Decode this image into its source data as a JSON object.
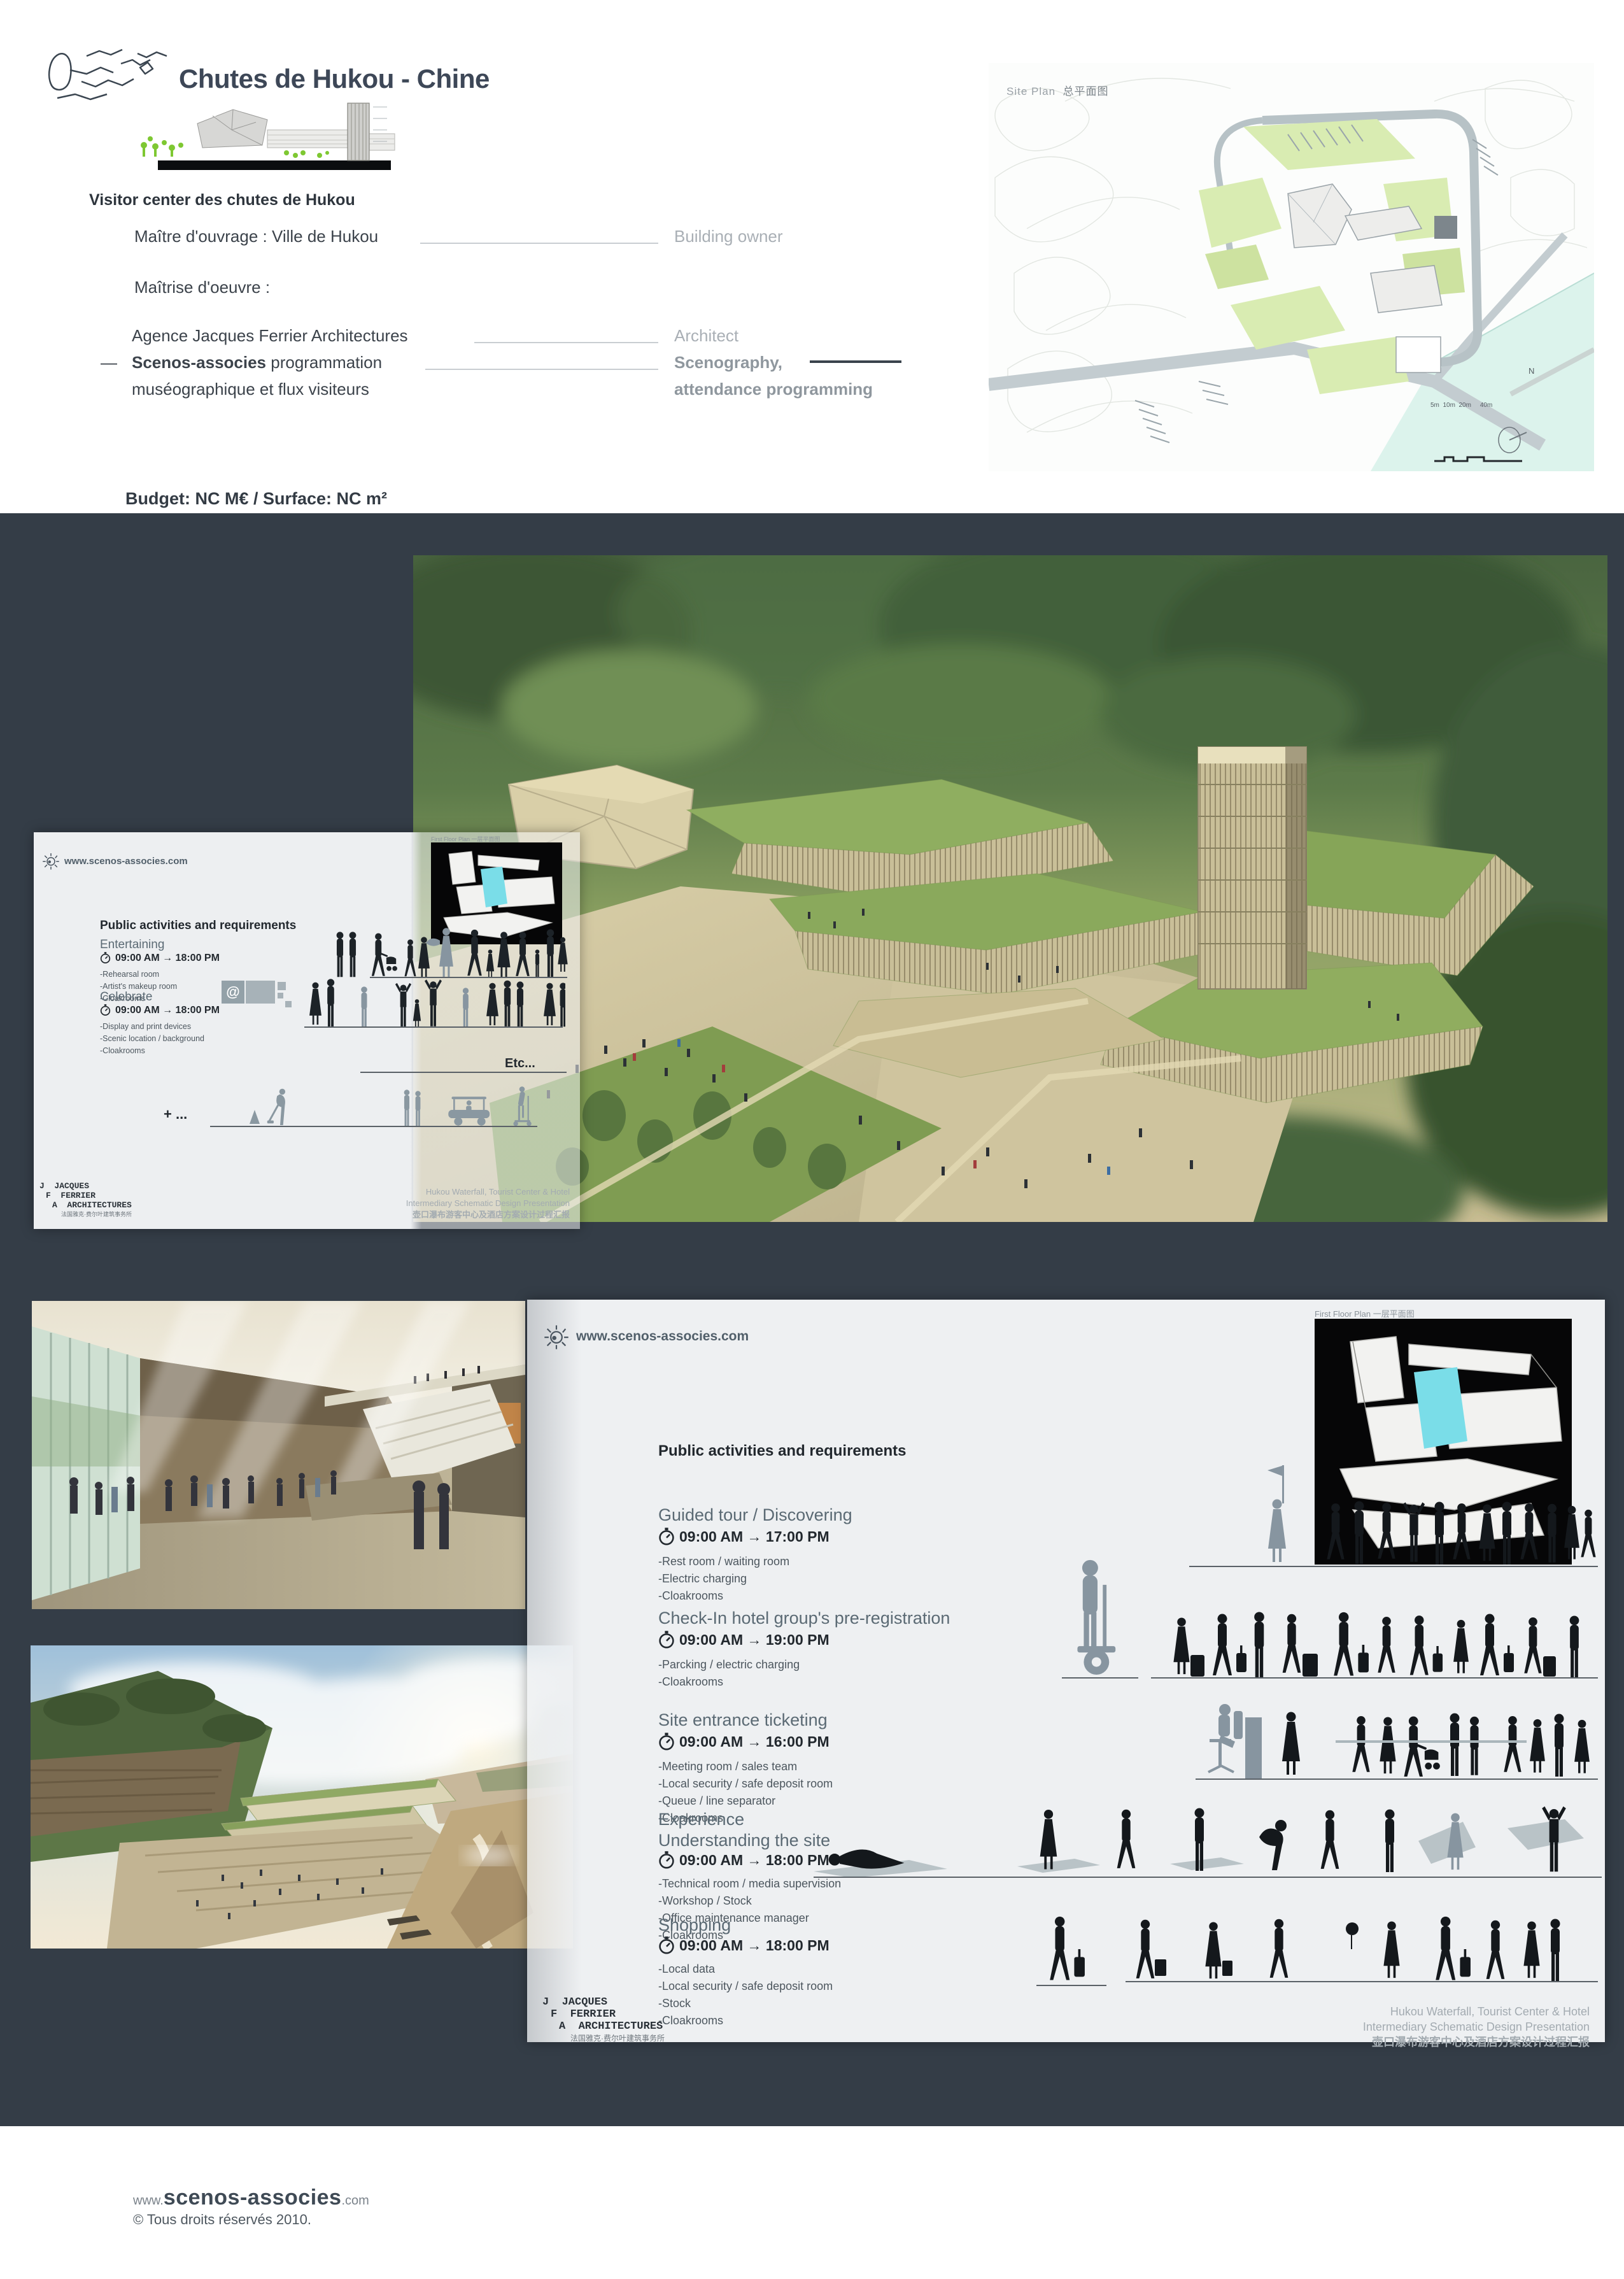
{
  "header": {
    "title": "Chutes de Hukou - Chine",
    "project_heading": "Visitor center des chutes de Hukou",
    "owner_label": "Maître d'ouvrage : Ville de Hukou",
    "owner_en": "Building owner",
    "moe_label": "Maîtrise d'oeuvre :",
    "architect_label": "Agence Jacques Ferrier Architectures",
    "architect_en": "Architect",
    "sceno_dash": "—",
    "sceno_name": "Scenos-associes",
    "sceno_rest": " programmation",
    "sceno_line2": "muséographique et flux visiteurs",
    "sceno_en1": "Scenography,",
    "sceno_en2": "attendance programming",
    "budget": "Budget: NC M€ / Surface: NC m²",
    "site_plan_label": "Site Plan",
    "site_plan_label_cn": "总平面图",
    "compass_n": "N",
    "scale_ticks": [
      "5m",
      "10m",
      "20m",
      "40m"
    ]
  },
  "slide1": {
    "website": "www.scenos-associes.com",
    "plan_label": "First Floor Plan  一层平面图",
    "heading": "Public activities and requirements",
    "media_at": "@",
    "sections": [
      {
        "title": "Entertaining",
        "time": "09:00 AM → 18:00 PM",
        "bullets": [
          "-Rehearsal room",
          "-Artist's makeup room",
          "-Cloakrooms"
        ]
      },
      {
        "title": "Celebrate",
        "time": "09:00 AM → 18:00 PM",
        "bullets": [
          "-Display and print devices",
          "-Scenic location / background",
          "-Cloakrooms"
        ]
      }
    ],
    "etc": "Etc...",
    "plus": "+ ...",
    "jfa": [
      "J  JACQUES",
      "F  FERRIER",
      "A  ARCHITECTURES"
    ],
    "jfa_cn": "法国雅克·费尔叶建筑事务所",
    "caption": [
      "Hukou Waterfall, Tourist Center & Hotel",
      "Intermediary Schematic Design Presentation",
      "壶口瀑布游客中心及酒店方案设计过程汇报"
    ]
  },
  "slide2": {
    "website": "www.scenos-associes.com",
    "plan_label": "First Floor Plan  一层平面图",
    "heading": "Public activities and requirements",
    "sections": [
      {
        "title": "Guided  tour / Discovering",
        "time": "09:00 AM → 17:00 PM",
        "bullets": [
          "-Rest room / waiting room",
          "-Electric charging",
          "-Cloakrooms"
        ]
      },
      {
        "title": "Check-In hotel group's pre-registration",
        "time": "09:00 AM → 19:00 PM",
        "bullets": [
          "-Parcking / electric charging",
          "-Cloakrooms"
        ]
      },
      {
        "title": "Site entrance ticketing",
        "time": "09:00 AM → 16:00 PM",
        "bullets": [
          "-Meeting room / sales team",
          "-Local security / safe deposit room",
          "-Queue / line separator",
          "-Cloakrooms"
        ]
      },
      {
        "title": "Experience",
        "title2": "Understanding the site",
        "time": "09:00 AM → 18:00 PM",
        "bullets": [
          "-Technical room / media supervision",
          "-Workshop / Stock",
          "-Office maintenance manager",
          "-Cloakrooms"
        ]
      },
      {
        "title": "Shopping",
        "time": "09:00 AM → 18:00 PM",
        "bullets": [
          "-Local data",
          "-Local security / safe deposit room",
          "-Stock",
          "-Cloakrooms"
        ]
      }
    ],
    "jfa": [
      "J  JACQUES",
      "F  FERRIER",
      "A  ARCHITECTURES"
    ],
    "jfa_cn": "法国雅克·费尔叶建筑事务所",
    "caption": [
      "Hukou Waterfall, Tourist Center & Hotel",
      "Intermediary Schematic Design Presentation",
      "壶口瀑布游客中心及酒店方案设计过程汇报"
    ]
  },
  "footer": {
    "url_prefix": "www.",
    "url_name": "scenos-associes",
    "url_suffix": ".com",
    "copyright": "© Tous droits réservés 2010."
  }
}
